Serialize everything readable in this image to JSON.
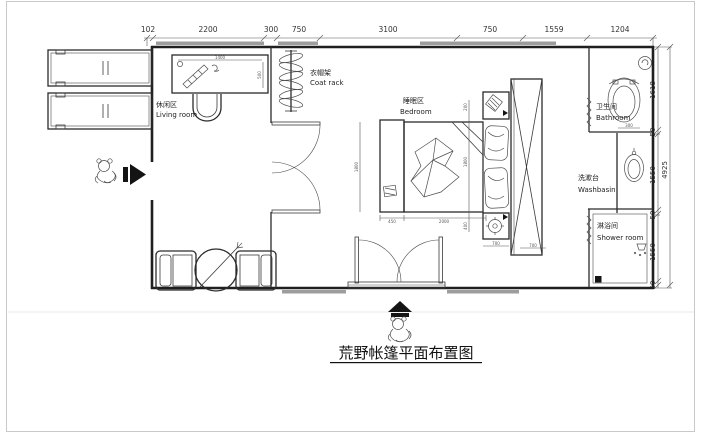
{
  "title": "荒野帐篷平面布置图",
  "dims_top": [
    "102",
    "2200",
    "300",
    "750",
    "3100",
    "750",
    "1559",
    "1204"
  ],
  "dims_right": {
    "segments": [
      "1618",
      "50",
      "1550",
      "50",
      "1550",
      "50"
    ],
    "total": "4925"
  },
  "dims_inner": {
    "desk_w": "1400",
    "desk_d": "500",
    "bed_len": "1800",
    "bed_w": "2000",
    "bench_w": "450",
    "night_w": "700",
    "ward_w": "700",
    "gap": "400",
    "head": "200",
    "bath": "300"
  },
  "rooms": {
    "living": {
      "zh": "休闲区",
      "en": "Living room"
    },
    "coat_rack": {
      "zh": "衣帽架",
      "en": "Coat rack"
    },
    "bedroom": {
      "zh": "睡眠区",
      "en": "Bedroom"
    },
    "bathroom": {
      "zh": "卫生间",
      "en": "Bathroom"
    },
    "washbasin": {
      "zh": "洗漱台",
      "en": "Washbasin"
    },
    "shower": {
      "zh": "淋浴间",
      "en": "Shower room"
    }
  }
}
